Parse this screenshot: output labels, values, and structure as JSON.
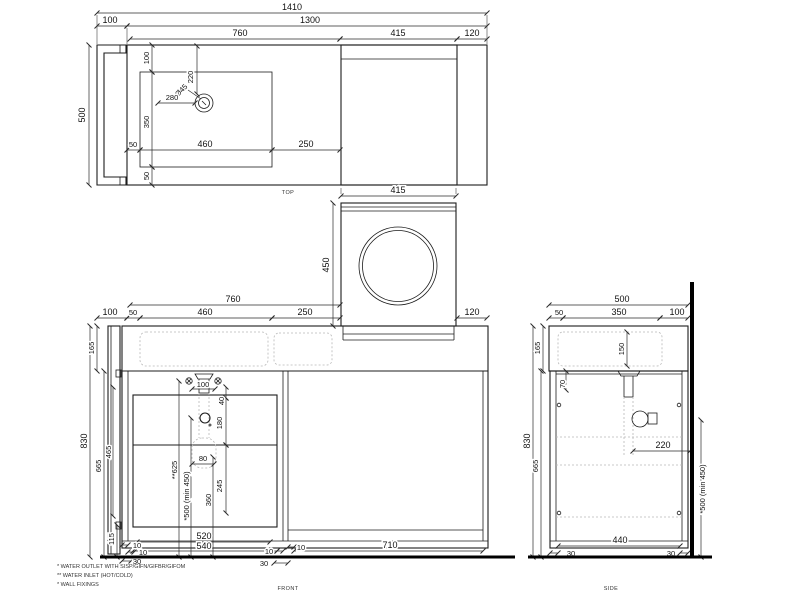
{
  "colors": {
    "line": "#1c1c1c",
    "dimension": "#2a2a2a",
    "hidden_dash": "#b8b8b8",
    "background": "#ffffff"
  },
  "views": {
    "top": {
      "label": "TOP",
      "d1410": "1410",
      "d100": "100",
      "d1300": "1300",
      "d760": "760",
      "d415": "415",
      "d120": "120",
      "d500": "500",
      "d100b": "100",
      "d220": "220",
      "dia45": "Ø45",
      "d280": "280",
      "d350": "350",
      "d50l": "50",
      "d460": "460",
      "d250": "250",
      "d50b": "50"
    },
    "washer": {
      "d415": "415",
      "d450": "450"
    },
    "front": {
      "label": "FRONT",
      "d760": "760",
      "d100": "100",
      "d50": "50",
      "d460": "460",
      "d250": "250",
      "d120": "120",
      "d165": "165",
      "d830": "830",
      "d665": "665",
      "d465": "465",
      "d115": "115",
      "d100i": "100",
      "d40": "40",
      "d180": "180",
      "d80": "80",
      "d625": "**625",
      "d500min": "*500 (min 450)",
      "d360": "360",
      "d245": "245",
      "d10a": "10",
      "d10b": "10",
      "d30a": "30",
      "d520": "520",
      "d540": "540",
      "d10c": "10",
      "d30b": "30",
      "d10d": "10",
      "d710": "710"
    },
    "side": {
      "label": "SIDE",
      "d500": "500",
      "d50": "50",
      "d350": "350",
      "d100": "100",
      "d165": "165",
      "d150": "150",
      "d70": "70",
      "d830": "830",
      "d665": "665",
      "d220": "220",
      "d500min": "*500 (min 450)",
      "d440": "440",
      "d30f": "30",
      "d30b": "30"
    }
  },
  "footnotes": {
    "f1": "* WATER OUTLET WITH SISP/GIFN/GIFBR/GIFOM",
    "f2": "** WATER INLET  (HOT/COLD)",
    "f3": "* WALL FIXINGS"
  }
}
